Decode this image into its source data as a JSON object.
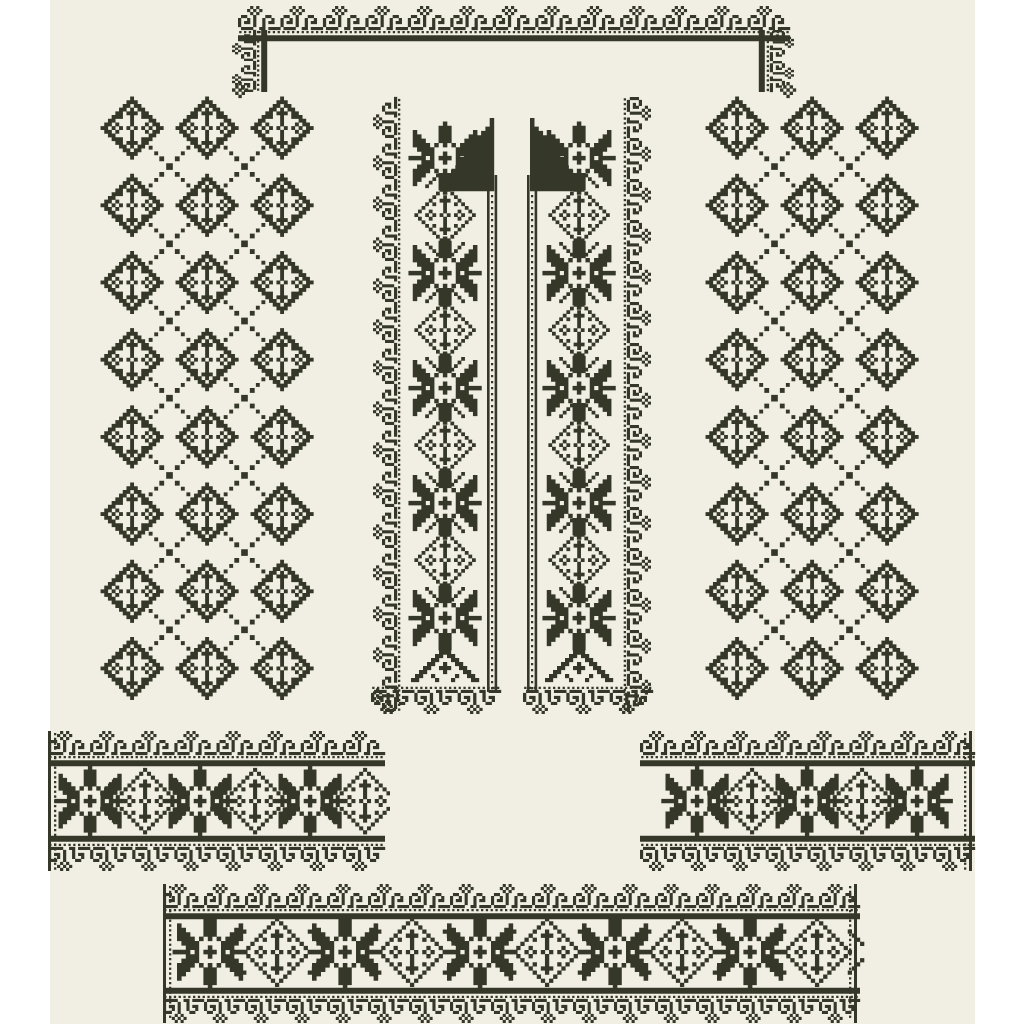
{
  "page": {
    "background": "#ffffff",
    "canvas_color": "#f1eee3",
    "ink": "#353828",
    "canvas": {
      "x": 50,
      "y": 0,
      "width": 925,
      "height": 1024
    }
  },
  "artwork": {
    "kind": "folk-cross-stitch-embroidery-pattern-set",
    "motifs": {
      "curl": [
        "....#.#.......",
        "...#.#.#......",
        "....#.#.......",
        ".##..#...##...",
        "#..#.#..#..#..",
        "#.##.#..#.##..",
        "#....#..#.....",
        ".####..##.####"
      ],
      "flower11": [
        ".....#.....",
        "....###....",
        "..#..#..#..",
        ".....#.....",
        ".#...#...#.",
        "#.#.#.#.#.#",
        ".#...#...#.",
        ".....#.....",
        "..#..#..#..",
        "....###....",
        ".....#....."
      ],
      "star17": [
        "........#........",
        ".......###.......",
        ".#.....###.....#.",
        ".##....###....##.",
        ".###...###...###.",
        ".####.#.#.#.####.",
        "..####.....####..",
        "...###..#..###...",
        "####.#.###.#.####",
        "...###..#..###...",
        "..####.....####..",
        ".####.#.#.#.####.",
        ".###...###...###.",
        ".##....###....##.",
        ".#.....###.....#.",
        ".......###.......",
        "........#........"
      ],
      "chevron": [
        "........#........",
        ".......###.......",
        "......##.##......",
        ".....##...##.....",
        "....##..#..##....",
        "...##..###..##...",
        "..##....#....##..",
        ".##..#.....#..##.",
        "##....#...#....##"
      ],
      "flower5": [
        "..#..",
        ".#.#.",
        "#.#.#",
        ".#.#.",
        "..#.."
      ],
      "flag": [
        "...........#",
        "...........#",
        "..........##",
        ".........###",
        "........####",
        "........####",
        ".......#####",
        "......######",
        ".....#######",
        "....########",
        "....########",
        "...#########",
        "..##########",
        ".###########",
        "############",
        "############",
        "############"
      ]
    },
    "pieces": {
      "neckline": {
        "top": {
          "x": 238,
          "y": 6,
          "len": 552
        },
        "drops": {
          "left": {
            "tx": 232,
            "ty": 92,
            "rot": -90
          },
          "right": {
            "tx": 794,
            "ty": 30,
            "rot": 90
          },
          "len": 62,
          "units": 2
        },
        "finials": [
          [
            240,
            90
          ],
          [
            788,
            90
          ]
        ]
      },
      "panels": [
        {
          "name": "left-sleeve-panel",
          "cols": [
            132,
            207,
            282
          ],
          "rowStart": 128,
          "rowStep": 77.2,
          "rowCount": 8,
          "cell": 3.7
        },
        {
          "name": "right-sleeve-panel",
          "cols": [
            737,
            812,
            887
          ],
          "rowStart": 128,
          "rowStep": 77.2,
          "rowCount": 8,
          "cell": 3.7
        }
      ],
      "bands": [
        {
          "name": "left-front-band",
          "outer": {
            "tx": 373,
            "ty": 712,
            "rot": -90,
            "len": 615
          },
          "bottom": {
            "tx": 371,
            "ty": 714,
            "len": 130
          },
          "cx": 445,
          "starYs": [
            158,
            273,
            388,
            503,
            618
          ],
          "rosetteYs": [
            215,
            330,
            445,
            560
          ],
          "chevronY": 664,
          "flag": {
            "x": 442.4,
            "y": 118,
            "mirror": false
          },
          "ladder": {
            "x": 487,
            "y1": 175,
            "y2": 692
          },
          "starCell": 4.3,
          "rosetteCell": 3.6
        },
        {
          "name": "right-front-band",
          "outer": {
            "tx": 651,
            "ty": 97,
            "rot": 90,
            "len": 615
          },
          "bottom": {
            "tx": 523,
            "ty": 714,
            "len": 130
          },
          "cx": 579,
          "starYs": [
            158,
            273,
            388,
            503,
            618
          ],
          "rosetteYs": [
            215,
            330,
            445,
            560
          ],
          "chevronY": 664,
          "flag": {
            "x": 530,
            "y": 118,
            "mirror": true
          },
          "ladder": {
            "x": 527,
            "y1": 175,
            "y2": 692
          },
          "starCell": 4.3,
          "rosetteCell": 3.6
        }
      ],
      "strips": [
        {
          "name": "left-cuff-strip",
          "clip": [
            44,
            724,
            346,
            152
          ],
          "top": {
            "x": 48,
            "y": 731,
            "len": 337
          },
          "bottom": {
            "x": 48,
            "y": 871,
            "len": 337
          },
          "edges": [
            {
              "x": 48,
              "dotOff": 6
            }
          ],
          "starXs": [
            90,
            200,
            310
          ],
          "rosetteXs": [
            145,
            255,
            365
          ],
          "cy": 801,
          "starCell": 4.2,
          "rosetteCell": 3.9
        },
        {
          "name": "right-cuff-strip",
          "clip": [
            638,
            724,
            346,
            152
          ],
          "top": {
            "x": 640,
            "y": 731,
            "len": 335
          },
          "bottom": {
            "x": 640,
            "y": 871,
            "len": 335
          },
          "edges": [
            {
              "x": 969,
              "dotOff": -5
            }
          ],
          "starXs": [
            697,
            807,
            917
          ],
          "rosetteXs": [
            752,
            862
          ],
          "cy": 801,
          "starCell": 4.2,
          "rosetteCell": 3.9
        },
        {
          "name": "hem-band",
          "clip": [
            158,
            878,
            710,
            152
          ],
          "top": {
            "x": 163,
            "y": 884,
            "len": 697
          },
          "bottom": {
            "x": 163,
            "y": 1023,
            "len": 697
          },
          "edges": [
            {
              "x": 163,
              "dotOff": 6
            },
            {
              "x": 854,
              "dotOff": -5
            }
          ],
          "starXs": [
            210,
            345,
            480,
            615,
            750
          ],
          "rosetteXs": [
            277,
            412,
            547,
            682,
            817
          ],
          "cy": 952,
          "starCell": 4.4,
          "rosetteCell": 4.1
        }
      ]
    }
  }
}
